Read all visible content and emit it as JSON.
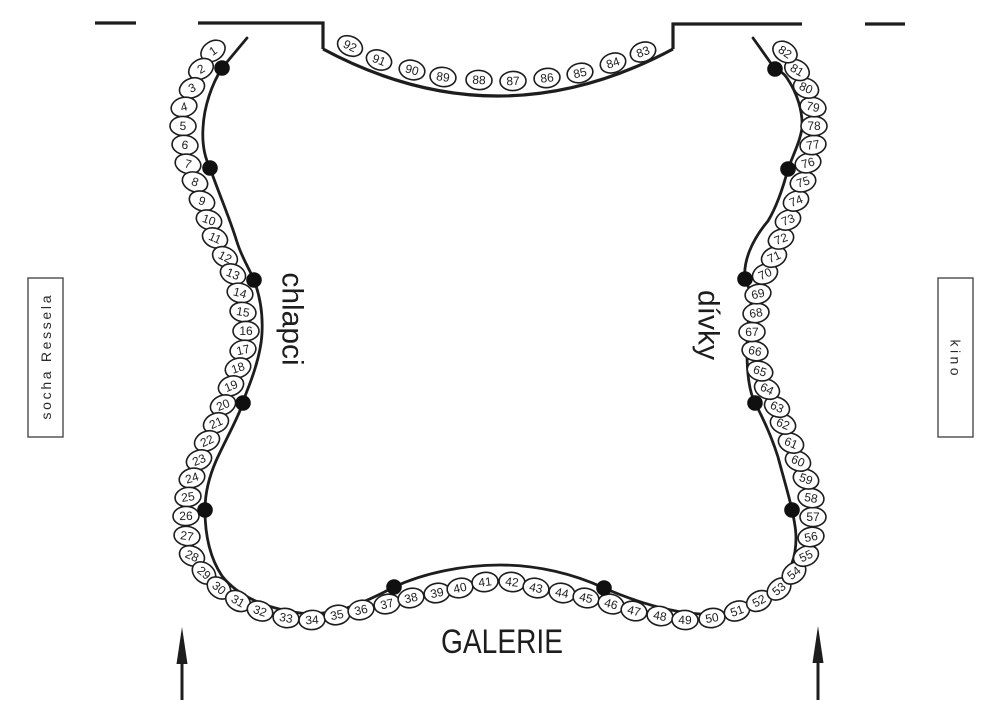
{
  "diagram": {
    "labels": {
      "left_section": "chlapci",
      "right_section": "dívky",
      "bottom": "GALERIE",
      "outside_left": "socha Ressela",
      "outside_right": "kino"
    },
    "colors": {
      "ink": "#1d1d1d",
      "seat_fill": "#ffffff"
    },
    "seats": {
      "perimeter": [
        [
          1,
          213,
          51
        ],
        [
          2,
          201,
          69
        ],
        [
          3,
          192,
          88
        ],
        [
          4,
          184,
          107
        ],
        [
          5,
          183,
          126
        ],
        [
          6,
          185,
          145
        ],
        [
          7,
          188,
          164
        ],
        [
          8,
          195,
          182
        ],
        [
          9,
          202,
          201
        ],
        [
          10,
          209,
          220
        ],
        [
          11,
          215,
          238
        ],
        [
          12,
          225,
          257
        ],
        [
          13,
          233,
          274
        ],
        [
          14,
          240,
          293
        ],
        [
          15,
          243,
          312
        ],
        [
          16,
          246,
          331
        ],
        [
          17,
          243,
          350
        ],
        [
          18,
          238,
          368
        ],
        [
          19,
          231,
          386
        ],
        [
          20,
          223,
          405
        ],
        [
          21,
          216,
          423
        ],
        [
          22,
          207,
          441
        ],
        [
          23,
          199,
          460
        ],
        [
          24,
          192,
          478
        ],
        [
          25,
          188,
          497
        ],
        [
          26,
          186,
          516
        ],
        [
          27,
          187,
          536
        ],
        [
          28,
          192,
          556
        ],
        [
          29,
          204,
          573
        ],
        [
          30,
          219,
          588
        ],
        [
          31,
          238,
          601
        ],
        [
          32,
          260,
          611
        ],
        [
          33,
          286,
          618
        ],
        [
          34,
          312,
          620
        ],
        [
          35,
          337,
          615
        ],
        [
          36,
          361,
          610
        ],
        [
          37,
          387,
          604
        ],
        [
          38,
          411,
          598
        ],
        [
          39,
          437,
          593
        ],
        [
          40,
          460,
          588
        ],
        [
          41,
          485,
          582
        ],
        [
          42,
          512,
          582
        ],
        [
          43,
          536,
          588
        ],
        [
          44,
          562,
          593
        ],
        [
          45,
          586,
          598
        ],
        [
          46,
          611,
          604
        ],
        [
          47,
          634,
          611
        ],
        [
          48,
          660,
          616
        ],
        [
          49,
          685,
          620
        ],
        [
          50,
          712,
          618
        ],
        [
          51,
          737,
          611
        ],
        [
          52,
          759,
          601
        ],
        [
          53,
          779,
          589
        ],
        [
          54,
          794,
          573
        ],
        [
          55,
          806,
          556
        ],
        [
          56,
          811,
          537
        ],
        [
          57,
          813,
          517
        ],
        [
          58,
          811,
          498
        ],
        [
          59,
          806,
          479
        ],
        [
          60,
          798,
          461
        ],
        [
          61,
          791,
          443
        ],
        [
          62,
          783,
          424
        ],
        [
          63,
          777,
          407
        ],
        [
          64,
          767,
          389
        ],
        [
          65,
          760,
          371
        ],
        [
          66,
          755,
          351
        ],
        [
          67,
          752,
          332
        ],
        [
          68,
          756,
          313
        ],
        [
          69,
          758,
          294
        ],
        [
          70,
          765,
          274
        ],
        [
          71,
          774,
          257
        ],
        [
          72,
          781,
          239
        ],
        [
          73,
          788,
          220
        ],
        [
          74,
          796,
          201
        ],
        [
          75,
          803,
          182
        ],
        [
          76,
          808,
          163
        ],
        [
          77,
          813,
          145
        ],
        [
          78,
          814,
          126
        ],
        [
          79,
          813,
          107
        ],
        [
          80,
          806,
          88
        ],
        [
          81,
          797,
          70
        ],
        [
          82,
          785,
          52
        ]
      ],
      "balcony": [
        [
          92,
          350,
          46
        ],
        [
          91,
          379,
          60
        ],
        [
          90,
          412,
          70
        ],
        [
          89,
          443,
          77
        ],
        [
          88,
          479,
          80
        ],
        [
          87,
          513,
          81
        ],
        [
          86,
          547,
          78
        ],
        [
          85,
          580,
          73
        ],
        [
          84,
          613,
          63
        ],
        [
          83,
          643,
          52
        ]
      ]
    },
    "pillars": [
      [
        222,
        68
      ],
      [
        210,
        168
      ],
      [
        254,
        280
      ],
      [
        243,
        403
      ],
      [
        205,
        510
      ],
      [
        394,
        587
      ],
      [
        604,
        588
      ],
      [
        792,
        510
      ],
      [
        755,
        403
      ],
      [
        745,
        279
      ],
      [
        788,
        169
      ],
      [
        775,
        69
      ]
    ]
  }
}
